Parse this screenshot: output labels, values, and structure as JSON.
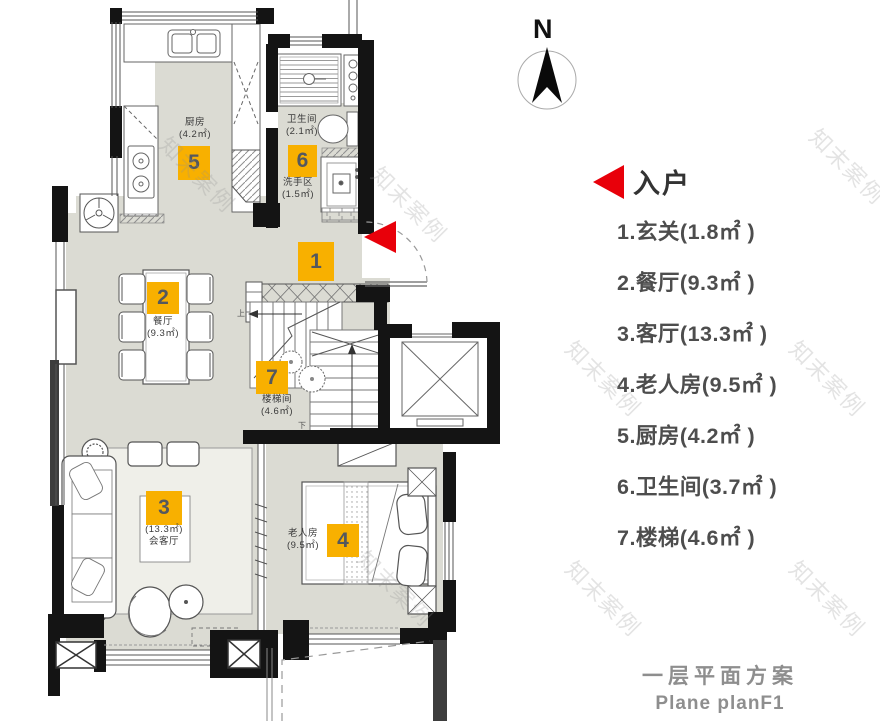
{
  "compass": {
    "label": "N"
  },
  "entry_marker": {
    "label": "入户"
  },
  "legend": {
    "items": [
      {
        "text": "1.玄关(1.8㎡ )"
      },
      {
        "text": "2.餐厅(9.3㎡ )"
      },
      {
        "text": "3.客厅(13.3㎡ )"
      },
      {
        "text": "4.老人房(9.5㎡ )"
      },
      {
        "text": "5.厨房(4.2㎡ )"
      },
      {
        "text": "6.卫生间(3.7㎡ )"
      },
      {
        "text": "7.楼梯(4.6㎡ )"
      }
    ]
  },
  "title": {
    "zh": "一层平面方案",
    "en": "Plane planF1"
  },
  "rooms": {
    "entry": {
      "badge": "1"
    },
    "dining": {
      "badge": "2",
      "name": "餐厅",
      "area": "(9.3㎡)"
    },
    "living": {
      "badge": "3",
      "area": "(13.3㎡)",
      "name": "会客厅"
    },
    "bedroom": {
      "badge": "4",
      "name": "老人房",
      "area": "(9.5㎡)"
    },
    "kitchen": {
      "badge": "5",
      "name": "厨房",
      "area": "(4.2㎡)"
    },
    "bath": {
      "badge": "6",
      "name": "卫生间",
      "area": "(2.1㎡)"
    },
    "washarea": {
      "name": "洗手区",
      "area": "(1.5㎡)"
    },
    "stairs": {
      "badge": "7",
      "name": "楼梯间",
      "area": "(4.6㎡)",
      "up": "上",
      "down": "下"
    }
  },
  "watermark": {
    "text": "知末案例"
  },
  "colors": {
    "badge": "#F8B000",
    "entry_arrow": "#E8000A",
    "floor": "#dbdbd3",
    "wall": "#141414"
  }
}
